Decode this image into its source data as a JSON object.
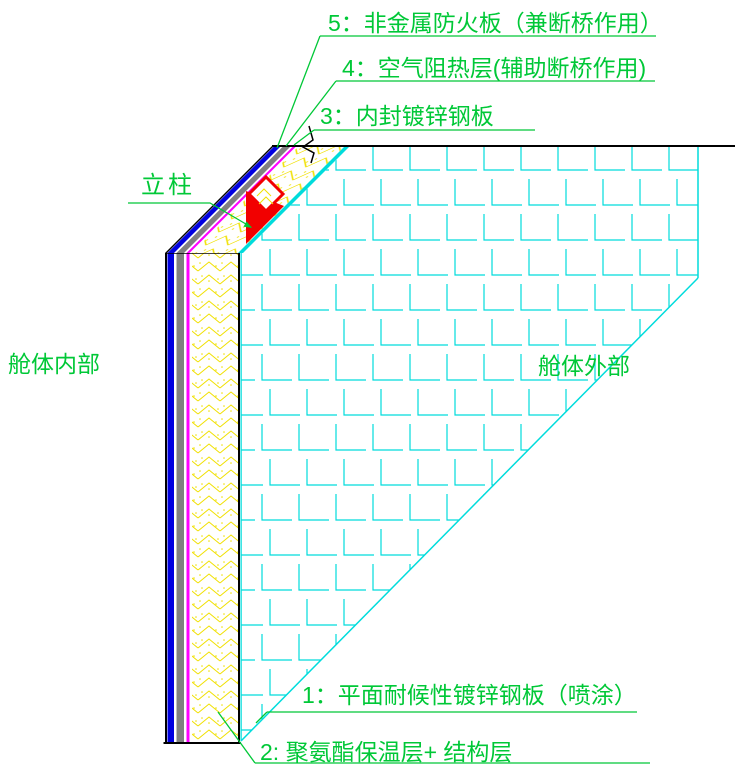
{
  "drawing": {
    "callouts": {
      "c5": "5：非金属防火板（兼断桥作用）",
      "c4": "4：空气阻热层(辅助断桥作用)",
      "c3": "3：内封镀锌钢板",
      "c1": "1：平面耐候性镀锌钢板（喷涂）",
      "c2": "2: 聚氨酯保温层+ 结构层",
      "column": "立柱",
      "cabin_interior": "舱体内部",
      "cabin_exterior": "舱体外部"
    },
    "colors": {
      "annotation_green": "#00c837",
      "outer_plate_cyan": "#00dcdc",
      "insulation_yellow": "#f0e000",
      "steel_blue": "#0000e0",
      "fireproof_gray": "#808080",
      "inner_plate_magenta": "#ff00ff",
      "column_red": "#f20000",
      "line_black": "#000000",
      "background": "#ffffff"
    }
  }
}
